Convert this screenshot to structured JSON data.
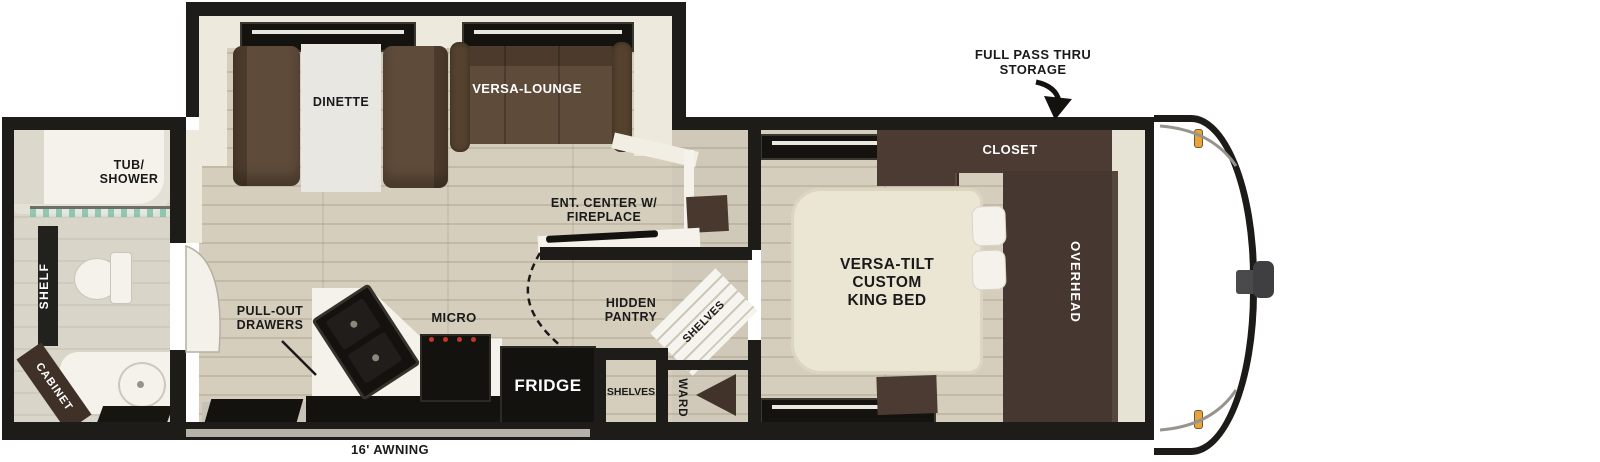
{
  "labels": {
    "storage_line1": "FULL PASS THRU",
    "storage_line2": "STORAGE",
    "closet": "CLOSET",
    "overhead": "OVERHEAD",
    "bed_line1": "VERSA-TILT",
    "bed_line2": "CUSTOM",
    "bed_line3": "KING BED",
    "dinette": "DINETTE",
    "versa_lounge": "VERSA-LOUNGE",
    "ent_center_line1": "ENT. CENTER W/",
    "ent_center_line2": "FIREPLACE",
    "pull_out_line1": "PULL-OUT",
    "pull_out_line2": "DRAWERS",
    "micro": "MICRO",
    "fridge": "FRIDGE",
    "hidden_pantry_line1": "HIDDEN",
    "hidden_pantry_line2": "PANTRY",
    "shelves_corner": "SHELVES",
    "shelves_room": "SHELVES",
    "ward": "WARD",
    "tub_line1": "TUB/",
    "tub_line2": "SHOWER",
    "shelf": "SHELF",
    "cabinet": "CABINET",
    "awning": "16' AWNING"
  },
  "colors": {
    "wall": "#1e1c19",
    "floor": "#d6cebc",
    "sofa_brown": "#5e4b3a",
    "cabinet_dark": "#4c3b32",
    "bed_cream": "#ebe6d3",
    "counter_white": "#f4f2ea",
    "appliance_black": "#14120f",
    "awning_gray": "#b5b1a8",
    "marker_light_orange": "#e8a33d",
    "shower_glass_teal": "#8fc9b4"
  }
}
